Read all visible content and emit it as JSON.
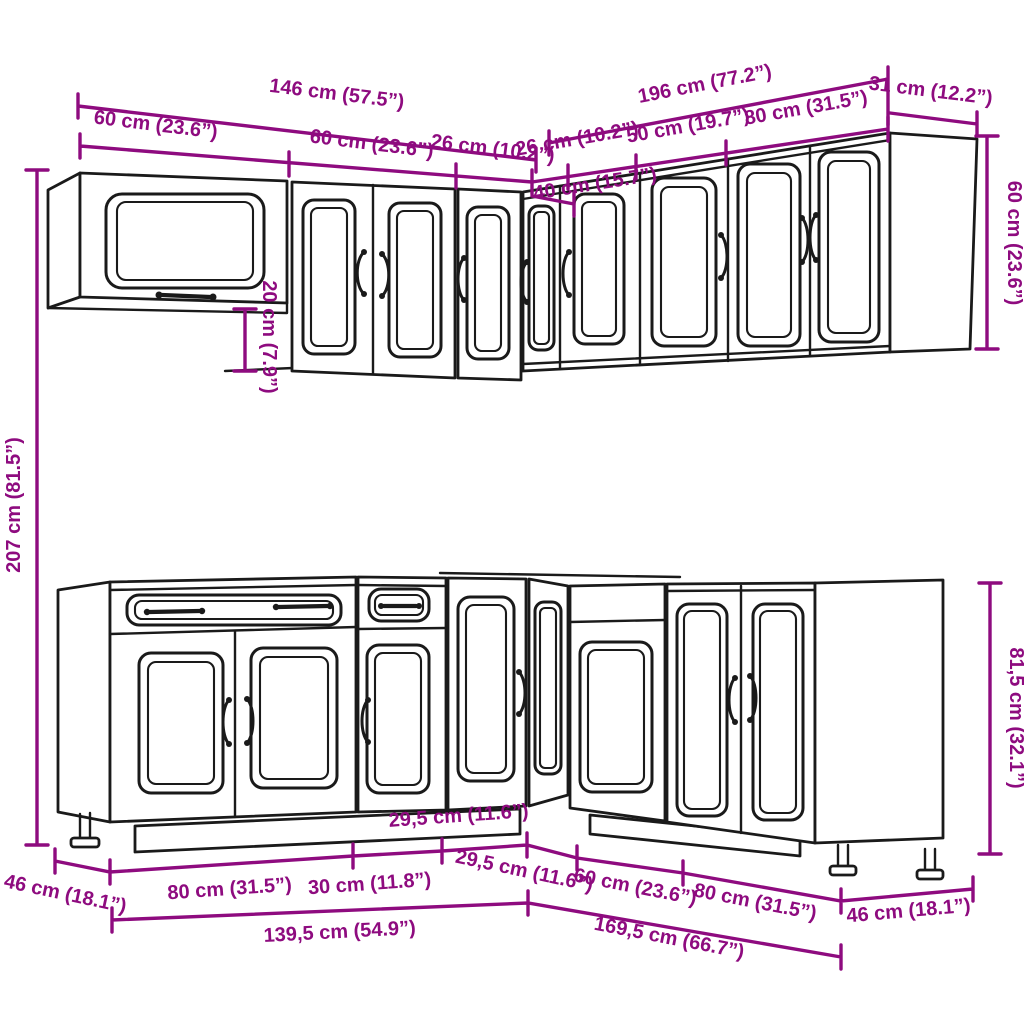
{
  "diagram": {
    "accent_color": "#8E0B7F",
    "line_color": "#1A1A1A",
    "labels": {
      "top_total_left": "146 cm (57.5”)",
      "top_total_right": "196 cm (77.2”)",
      "top_right_depth": "31 cm (12.2”)",
      "wall_left_cab": "60 cm (23.6”)",
      "wall_seg_60": "60 cm (23.6”)",
      "wall_seg_26_left": "26 cm (10.2”)",
      "wall_seg_26_right": "26 cm (10.2”)",
      "wall_seg_50": "50 cm (19.7”)",
      "wall_seg_80": "80 cm (31.5”)",
      "wall_corner_40": "40 cm (15.7”)",
      "wall_height_diff_20": "20 cm (7.9”)",
      "wall_height_60": "60 cm (23.6”)",
      "total_height_207": "207 cm (81.5”)",
      "base_height_815": "81,5 cm (32.1”)",
      "base_seg_295_a": "29,5 cm (11.6”)",
      "base_seg_295_b": "29,5 cm (11.6”)",
      "base_seg_80_left": "80 cm (31.5”)",
      "base_seg_30": "30 cm (11.8”)",
      "base_seg_60": "60 cm (23.6”)",
      "base_seg_80_right": "80 cm (31.5”)",
      "base_depth_left_46": "46 cm (18.1”)",
      "base_depth_right_46": "46 cm (18.1”)",
      "base_total_left_1395": "139,5 cm (54.9”)",
      "base_total_right_1695": "169,5 cm (66.7”)"
    }
  }
}
